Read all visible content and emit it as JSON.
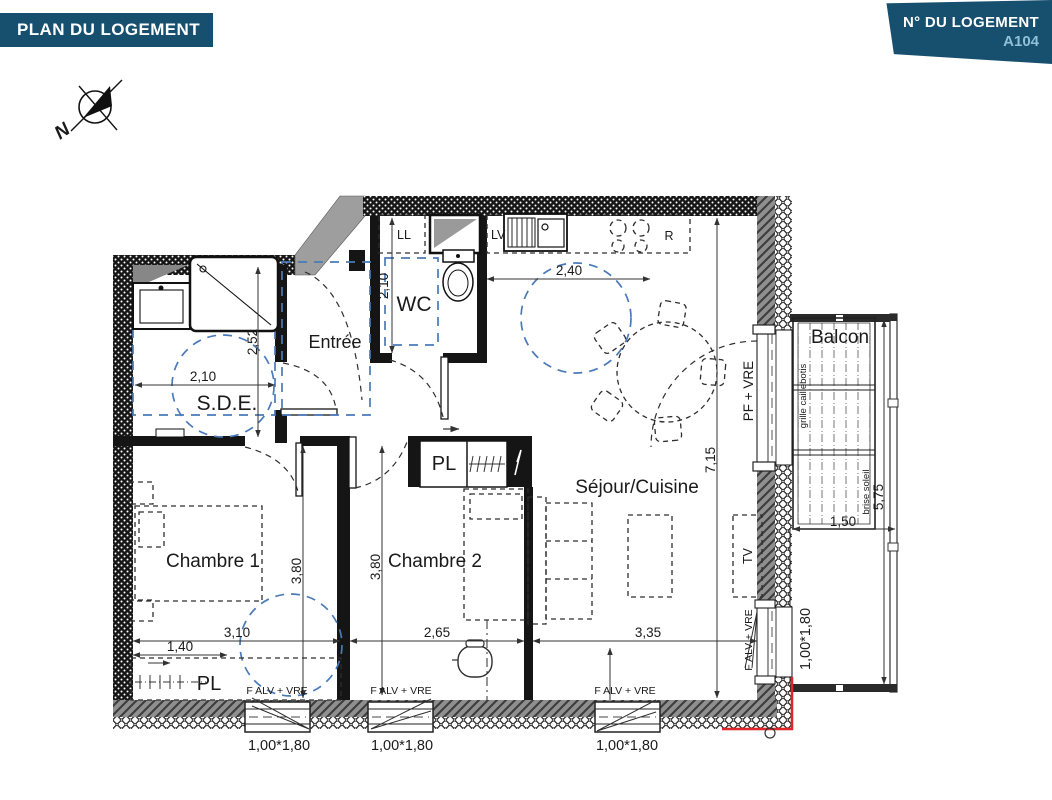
{
  "header": {
    "plan_title": "PLAN DU LOGEMENT",
    "unit_title": "N° DU LOGEMENT",
    "unit_number": "A104"
  },
  "compass": {
    "north": "N"
  },
  "rooms": {
    "entree": "Entrée",
    "wc": "WC",
    "sde": "S.D.E.",
    "chambre1": "Chambre 1",
    "chambre2": "Chambre 2",
    "sejour_cuisine": "Séjour/Cuisine",
    "balcon": "Balcon",
    "placard": "PL"
  },
  "fixtures": {
    "lave_linge": "LL",
    "lave_vaisselle": "LV",
    "refrigerateur": "R",
    "tv": "TV"
  },
  "openings": {
    "porte_fenetre": "PF + VRE",
    "fenetre_alv": "F ALV + VRE",
    "grille_caillebotis": "grille caillebotis",
    "brise_soleil": "brise soleil",
    "window_size": "1,00*1,80"
  },
  "dims": {
    "sde_width": "2,10",
    "sde_depth": "2,52",
    "wc_depth": "2,10",
    "cuisine_width": "2,40",
    "sejour_depth": "7,15",
    "chambre1_depth": "3,80",
    "chambre2_depth": "3,80",
    "chambre1_width": "3,10",
    "placard1_width": "1,40",
    "chambre2_width": "2,65",
    "sejour_width": "3,35",
    "balcon_depth": "1,50",
    "balcon_length": "5,75"
  },
  "colors": {
    "banner_blue": "#17506f",
    "unit_number_text": "#8fc0d8",
    "accessibility_blue": "#4a7ab8",
    "boundary_red": "#e02427"
  }
}
